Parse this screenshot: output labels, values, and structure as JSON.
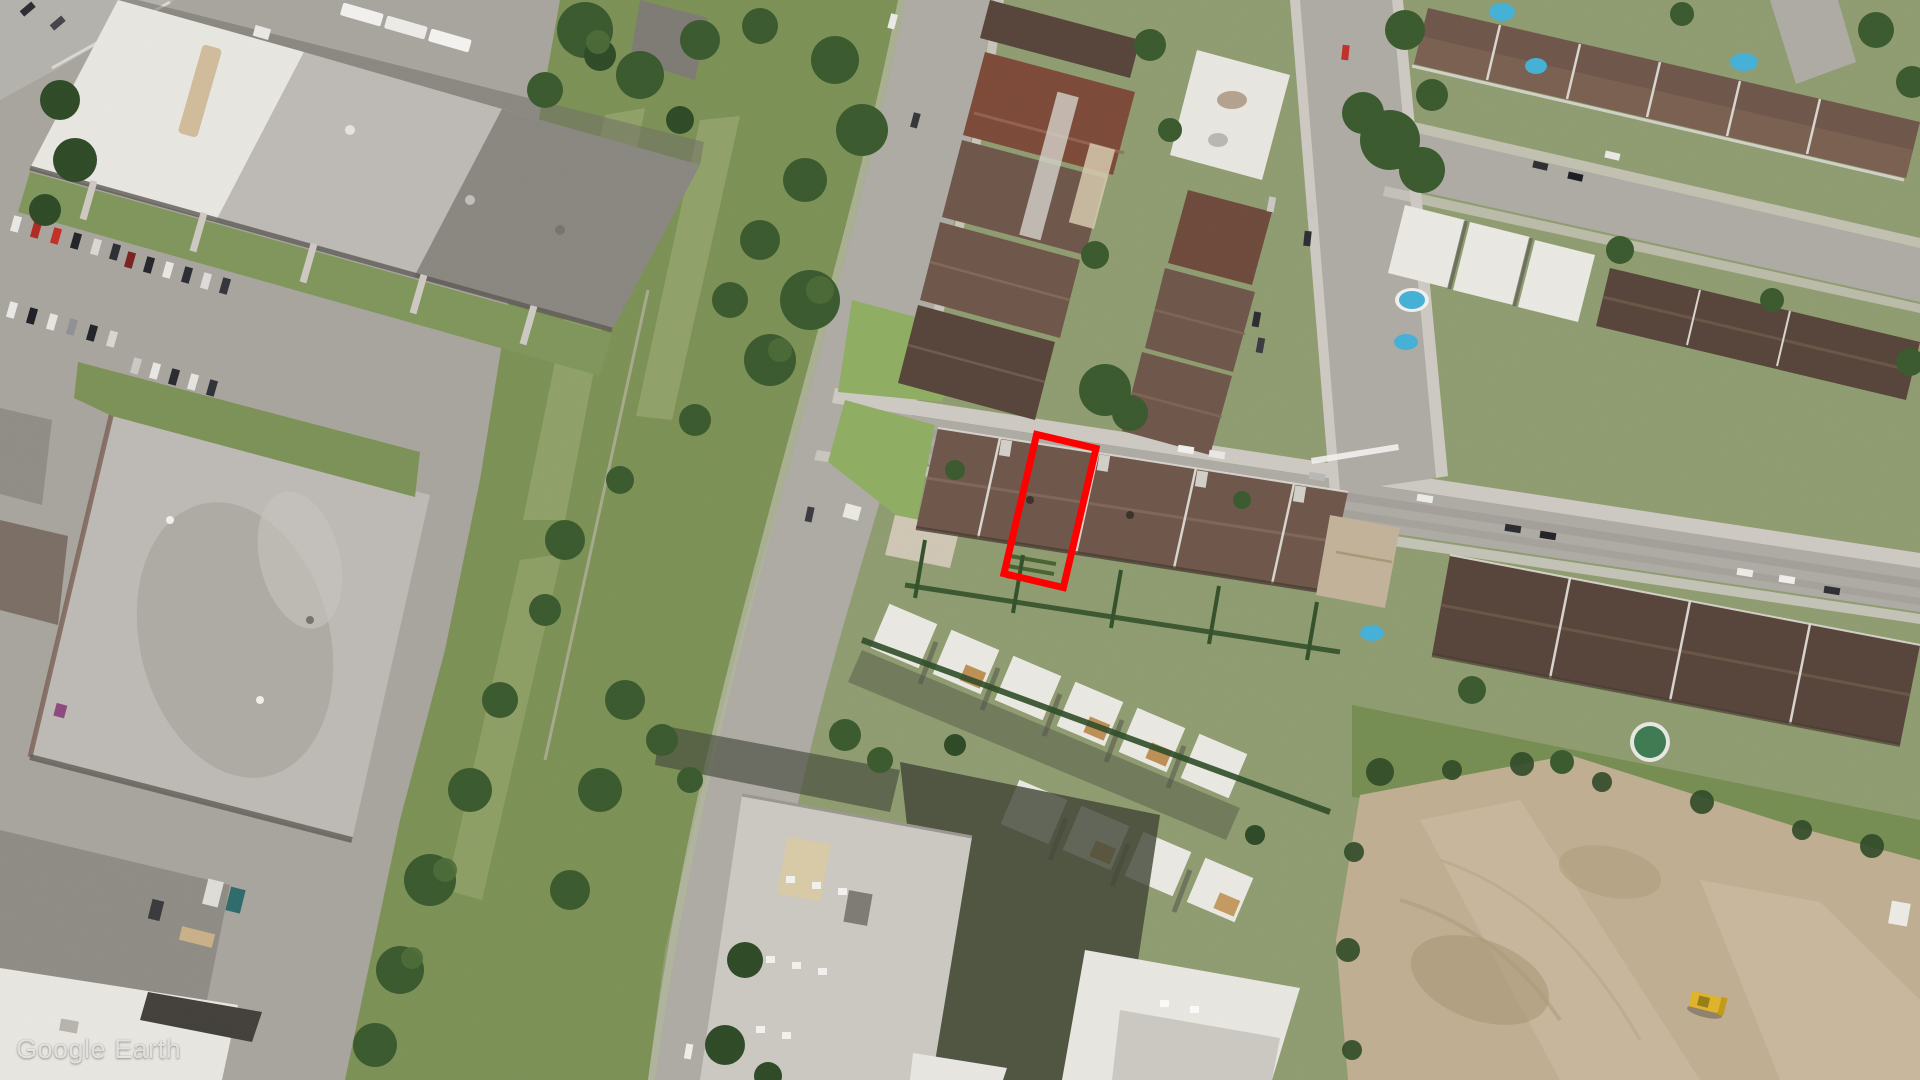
{
  "watermark": {
    "text": "Google Earth"
  },
  "annotation": {
    "shape": "rectangle-outline",
    "color": "#FF0000",
    "fill": "none",
    "center_x": 1050,
    "center_y": 511,
    "width": 68,
    "height": 150,
    "rotation_deg": 13.2,
    "stroke_width_px": 7
  },
  "palette": {
    "grass": "#8f9c70",
    "grass-bright": "#7c9156",
    "grass-lawn": "#8fae62",
    "tree": "#3a5a2e",
    "tree-dark": "#2f4a27",
    "road": "#aeaba5",
    "sidewalk": "#cdc9c2",
    "asphalt": "#a8a59e",
    "roof-brown": "#6e564a",
    "roof-dark-brown": "#57443a",
    "roof-red-brown": "#7d4a39",
    "ind-white": "#e8e6e0",
    "ind-gray": "#bdbab6",
    "ind-dark": "#8a8781",
    "dirt": "#bfae92",
    "bldg-light": "#cbc8c1",
    "white-roof": "#eae8e2",
    "pool": "#45b0d6"
  }
}
